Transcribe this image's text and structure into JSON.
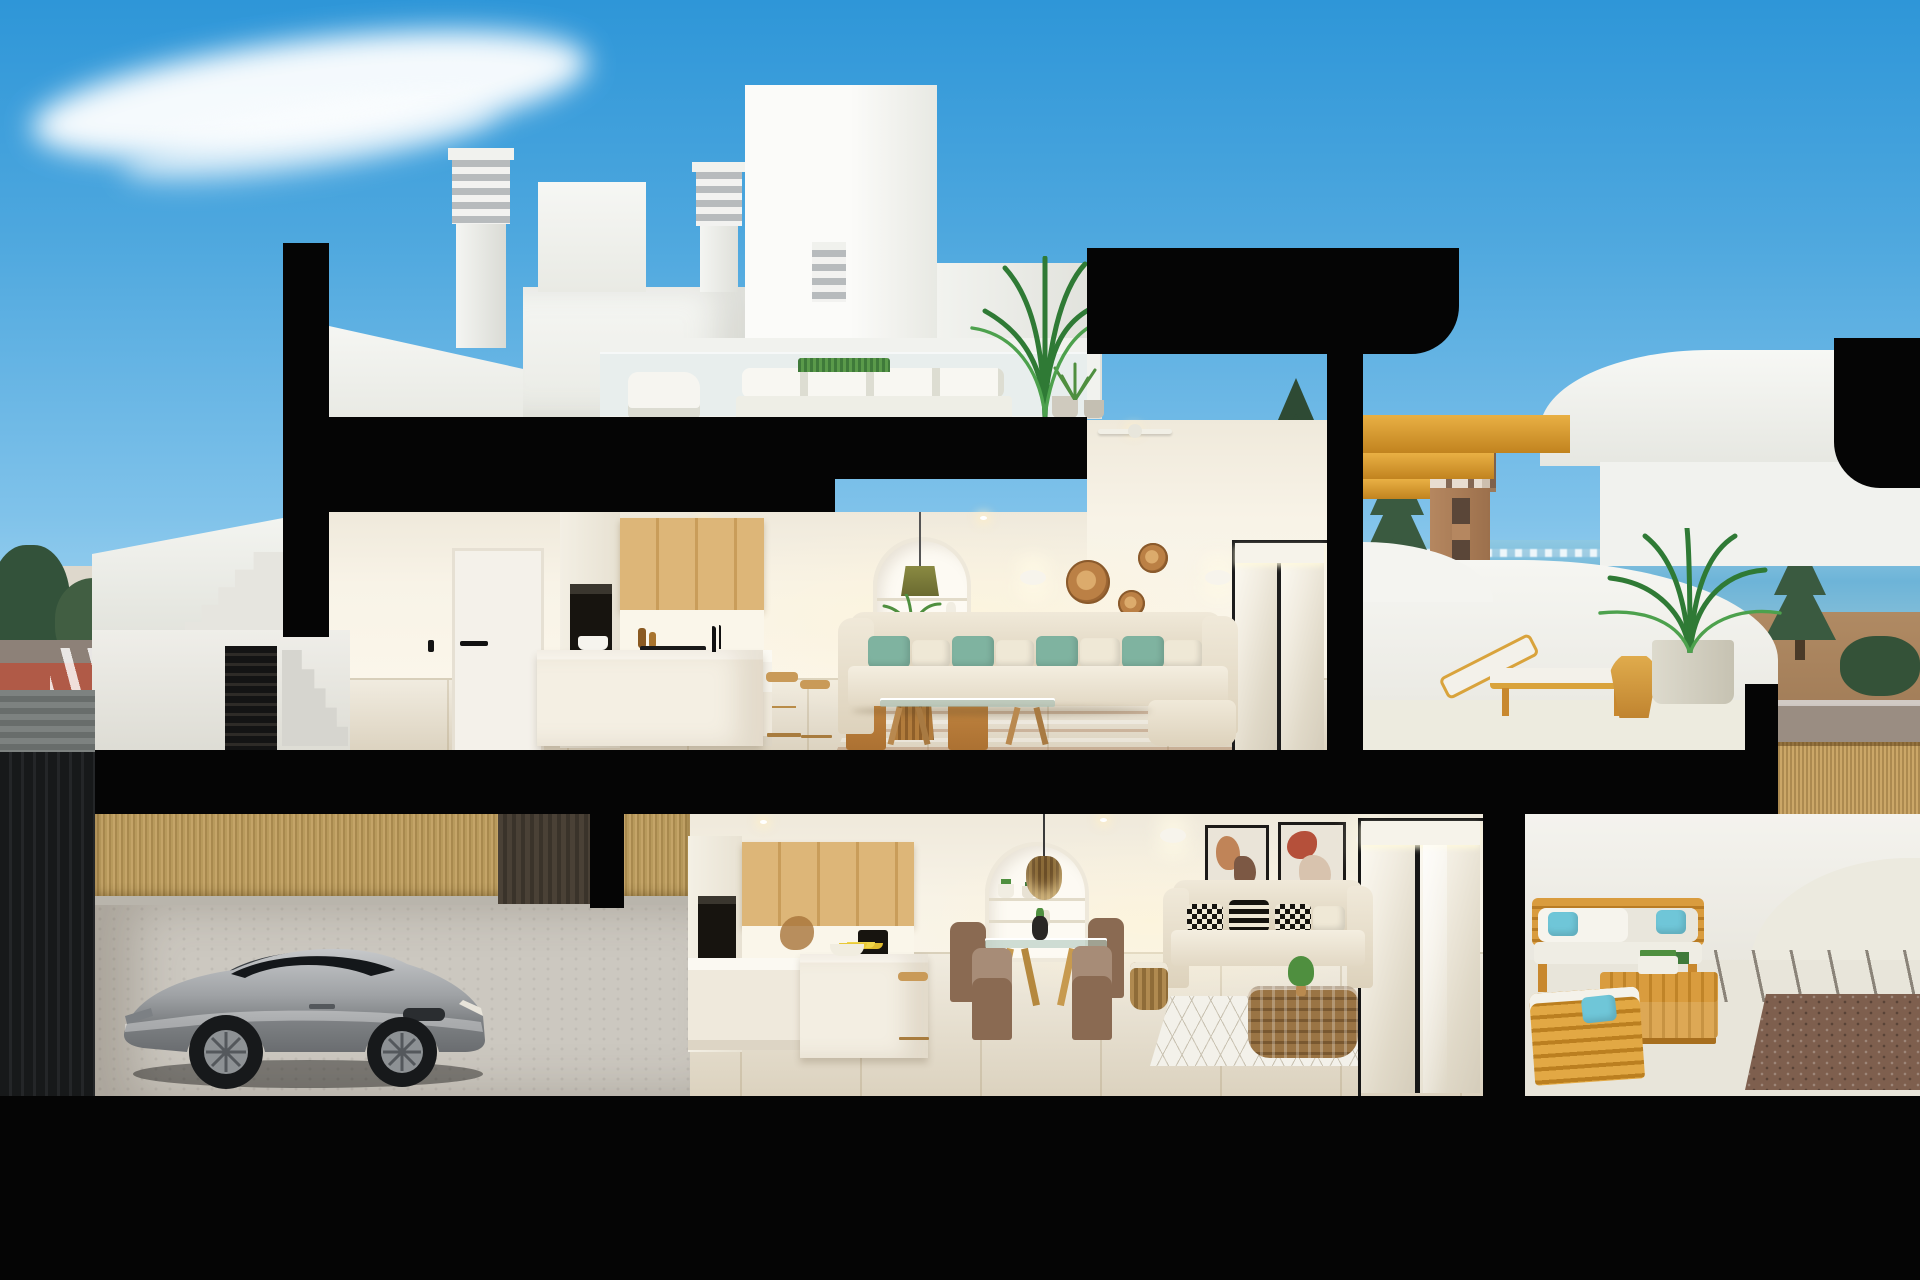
{
  "scene": {
    "title": "3D cutaway cross-section render of a two-storey coastal townhouse",
    "environment": {
      "sky": "clear blue sky with a long wispy cloud, brighter toward the horizon",
      "background_left": "Mediterranean town skyline, dark trees, street with pedestrian crossing and red bike lane",
      "background_right": "sea with distant shoreline, brick watchtower, conifer trees, dirt field, street lamps and reed fence"
    },
    "palette": {
      "sky_top": "#2e96d8",
      "sky_horizon": "#cfeaf7",
      "cut_structure": "#050505",
      "interior_wall": "#f8f3e7",
      "wood_cabinet": "#d9b678",
      "outdoor_wood": "#d99c3e",
      "sofa_cream": "#ece5d5",
      "accent_teal": "#7fb3a0",
      "accent_turquoise": "#6fc6d8",
      "rattan": "#c08b4f",
      "floor_tile": "#e9e1cf",
      "car_silver": "#a8abad",
      "reed_fence": "#c9a868",
      "sea": "#6db4d8",
      "bamboo_fence": "#b89a5c"
    },
    "levels": [
      {
        "name": "roof terrace",
        "items": [
          "louvered chimneys",
          "white stair bulkheads",
          "white outdoor lounge set",
          "potted palm",
          "planter boxes",
          "parapet walls"
        ]
      },
      {
        "name": "upper floor",
        "rooms": [
          {
            "name": "entry hall",
            "items": [
              "two white doors with black handles"
            ]
          },
          {
            "name": "kitchen",
            "items": [
              "oak upper cabinets",
              "built-in oven tower",
              "white island with faucet",
              "two wooden stools",
              "pot and bottles"
            ]
          },
          {
            "name": "living dining room",
            "items": [
              "round wooden dining table",
              "four wooden chairs",
              "arched shelf niche with olive pendant lamp",
              "coral vases",
              "trailing plant",
              "two wall sconces",
              "three rattan wall discs",
              "cream sofa with teal pillows",
              "glass coffee table",
              "striped jute rug",
              "ceiling fan",
              "sliding glass door"
            ]
          },
          {
            "name": "sun terrace",
            "items": [
              "curved white parapet",
              "wooden sun lounger with white cushion",
              "round wooden side table",
              "grey planter with palm"
            ]
          }
        ]
      },
      {
        "name": "ground floor",
        "rooms": [
          {
            "name": "kitchen",
            "items": [
              "oak upper cabinets",
              "oven tower",
              "black coffee machine",
              "white island",
              "wooden stool"
            ]
          },
          {
            "name": "living dining room",
            "items": [
              "arched niche with rattan pendant",
              "glass dining table with four brown chairs",
              "beige sofa with black-and-white pillows",
              "rattan basket coffee table",
              "white diamond rug",
              "two abstract wall prints",
              "wall sconces",
              "sliding glass doors"
            ]
          },
          {
            "name": "back terrace",
            "items": [
              "wooden outdoor sofa set",
              "white cushions",
              "turquoise pillows",
              "slatted wooden coffee table",
              "gravel bed",
              "paved patio"
            ]
          }
        ]
      },
      {
        "name": "street level",
        "items": [
          "silver sports coupe",
          "paved driveway",
          "bamboo screen fence",
          "white entrance stair",
          "dark louvered gate",
          "neighbouring dark garage wall"
        ]
      }
    ],
    "structure": {
      "cut_color_note": "all sectioned walls and slabs rendered solid black",
      "stair_soffit": "golden wood stair underside at upper right",
      "ground": "solid black base band"
    }
  }
}
